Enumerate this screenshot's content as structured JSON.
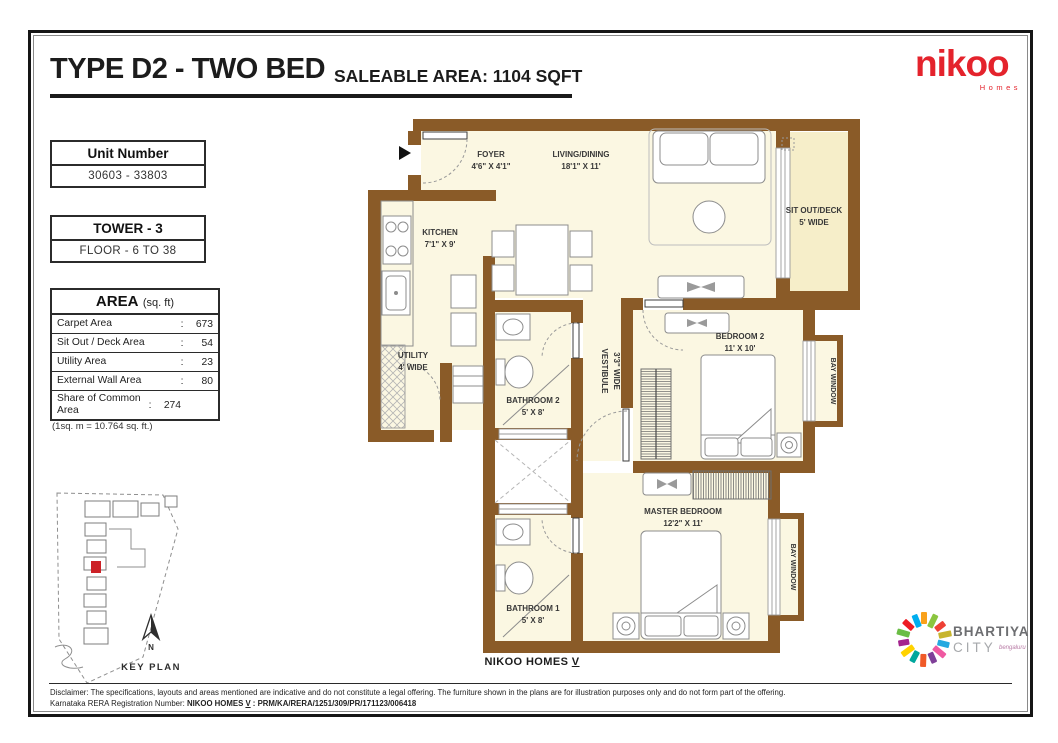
{
  "theme": {
    "wall": "#8a5b28",
    "floor": "#fbf7e2",
    "deck": "#f6eec9",
    "nikoo-red": "#e4232c",
    "marker-red": "#cc2127",
    "bhartiya-gray": "#6d6e71",
    "bhartiya-light": "#a7a9ac",
    "bengaluru": "#b87aa5"
  },
  "header": {
    "title": "TYPE D2 - TWO BED",
    "subtitle": "SALEABLE AREA: 1104 SQFT"
  },
  "brand": {
    "nikoo": "nikoo",
    "nikoo_sub": "Homes",
    "bhartiya_word1": "BHARTIYA",
    "bhartiya_word2": "CITY",
    "bhartiya_sub": "bengaluru",
    "ring": [
      "#f9a11b",
      "#8bc53f",
      "#ee4036",
      "#c7b52e",
      "#26a9e0",
      "#ef59a1",
      "#7f3f98",
      "#f05a28",
      "#00a79d",
      "#ffd200",
      "#a3238e",
      "#6abd45",
      "#ed1c24",
      "#00aeef"
    ]
  },
  "unit_box": {
    "header": "Unit Number",
    "value": "30603 - 33803"
  },
  "tower_box": {
    "header": "TOWER - 3",
    "value": "FLOOR - 6 TO 38"
  },
  "area_table": {
    "title": "AREA",
    "unit": "(sq. ft)",
    "colon": ":",
    "rows": [
      {
        "label": "Carpet Area",
        "value": "673"
      },
      {
        "label": "Sit Out / Deck Area",
        "value": "54"
      },
      {
        "label": "Utility Area",
        "value": "23"
      },
      {
        "label": "External Wall Area",
        "value": "80"
      },
      {
        "label": "Share of Common Area",
        "value": "274"
      }
    ],
    "note": "(1sq. m = 10.764 sq. ft.)"
  },
  "key_plan": {
    "label": "KEY PLAN",
    "north": "N"
  },
  "plan": {
    "footer_main": "NIKOO HOMES",
    "footer_roman": "V",
    "rooms": [
      {
        "name": "FOYER",
        "dims": "4'6\" X 4'1\""
      },
      {
        "name": "LIVING/DINING",
        "dims": "18'1\" X 11'"
      },
      {
        "name": "KITCHEN",
        "dims": "7'1\" X 9'"
      },
      {
        "name": "SIT OUT/DECK",
        "dims": "5' WIDE"
      },
      {
        "name": "UTILITY",
        "dims": "4' WIDE"
      },
      {
        "name": "BATHROOM 2",
        "dims": "5' X 8'"
      },
      {
        "name": "VESTIBULE",
        "dims": "3'3\" WIDE"
      },
      {
        "name": "BEDROOM 2",
        "dims": "11' X 10'"
      },
      {
        "name": "BAY WINDOW",
        "dims": ""
      },
      {
        "name": "MASTER BEDROOM",
        "dims": "12'2\" X 11'"
      },
      {
        "name": "BATHROOM 1",
        "dims": "5' X 8'"
      },
      {
        "name": "BAY WINDOW",
        "dims": ""
      }
    ]
  },
  "footer": {
    "line1": "Disclaimer: The specifications, layouts and areas mentioned are indicative and do not constitute a legal offering. The furniture shown in the plans are for illustration purposes only and do not form part of the offering.",
    "line2_prefix": "Karnataka RERA Registration Number: ",
    "line2_bold_a": "NIKOO HOMES ",
    "line2_roman": "V",
    "line2_bold_b": " : PRM/KA/RERA/1251/309/PR/171123/006418"
  }
}
